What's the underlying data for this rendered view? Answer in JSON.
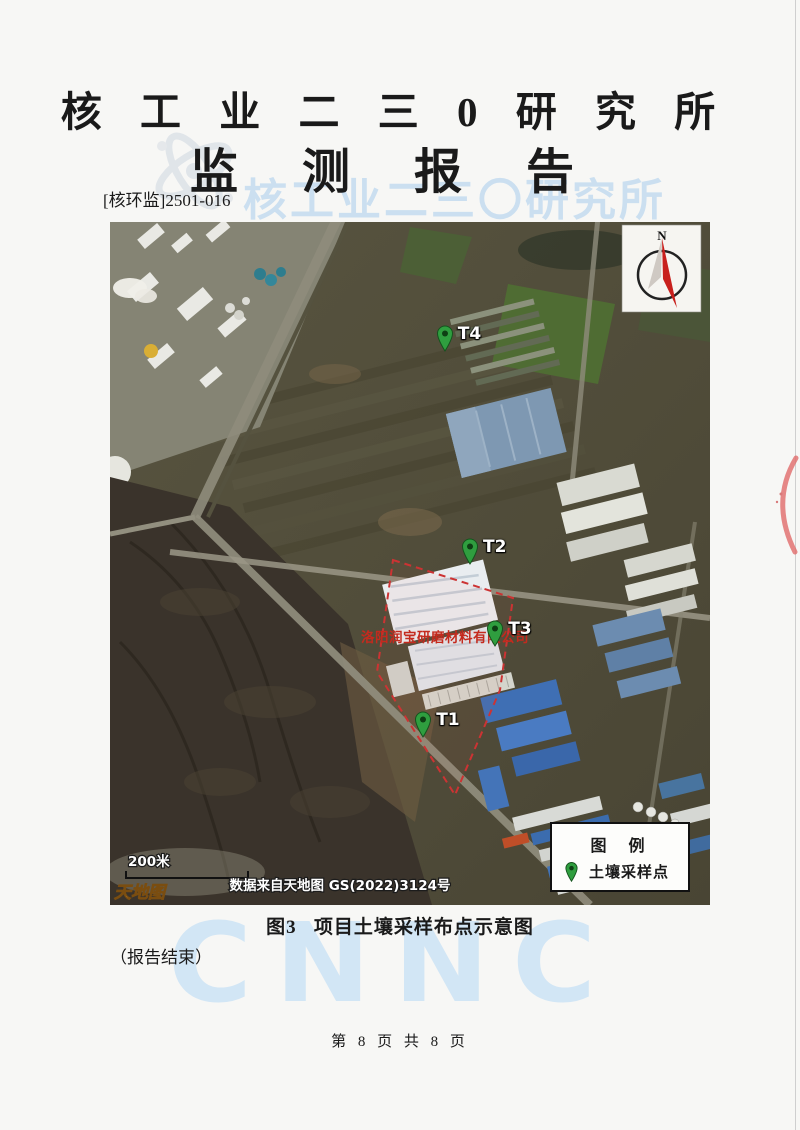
{
  "colors": {
    "pin": "#2f9e3f",
    "boundary": "#cc3333",
    "site-label": "#c42a1e",
    "wm-blue": "#cbdff0",
    "cnnc-blue": "#d2e6f5",
    "compass-red": "#c8201d"
  },
  "header": {
    "org_title": "核 工 业 二 三 0 研 究 所",
    "report_title": "监 测 报 告",
    "doc_number": "[核环监]2501-016",
    "watermark_text": "核工业二三〇研究所"
  },
  "map": {
    "compass_label": "N",
    "scale_label": "200米",
    "basemap_logo": "天地图",
    "attribution": "数据来自天地图 GS(2022)3124号",
    "site_label": "洛阳润宝研磨材料有限公司",
    "points": [
      {
        "label": "T1",
        "x_pct": 52.2,
        "y_pct": 75.5
      },
      {
        "label": "T2",
        "x_pct": 60.0,
        "y_pct": 50.2
      },
      {
        "label": "T3",
        "x_pct": 64.2,
        "y_pct": 62.2
      },
      {
        "label": "T4",
        "x_pct": 55.8,
        "y_pct": 19.0
      }
    ],
    "legend": {
      "title": "图 例",
      "item": "土壤采样点"
    }
  },
  "caption": "图3   项目土壤采样布点示意图",
  "end_note": "（报告结束）",
  "watermark_cnnc": "CNNC",
  "footer": "第 8 页 共 8 页"
}
